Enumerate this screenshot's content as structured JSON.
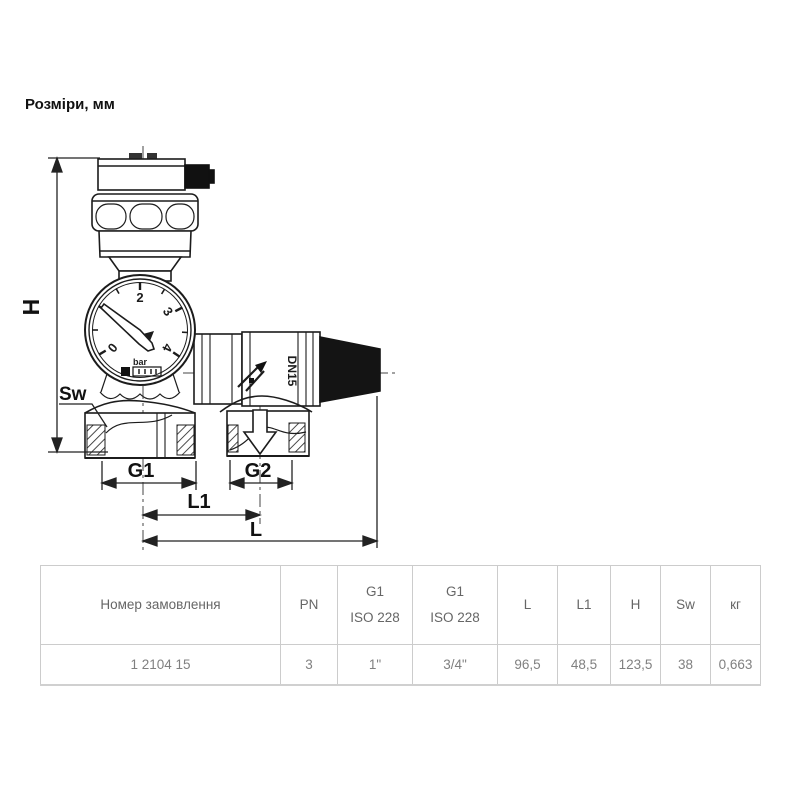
{
  "page": {
    "title": "Розміри, мм"
  },
  "drawing": {
    "dims": {
      "h": "H",
      "sw": "Sw",
      "g1": "G1",
      "g2": "G2",
      "l1": "L1",
      "l": "L"
    },
    "gauge": {
      "unit": "bar",
      "tick_0": "0",
      "tick_2": "2",
      "tick_3": "3",
      "tick_4": "4"
    },
    "valve": {
      "marking": "DN15"
    },
    "colors": {
      "line": "#1c1c1c",
      "cap_fill": "#141414",
      "centerline": "#444444"
    }
  },
  "table": {
    "columns": [
      {
        "line1": "Номер замовлення",
        "line2": ""
      },
      {
        "line1": "PN",
        "line2": ""
      },
      {
        "line1": "G1",
        "line2": "ISO 228"
      },
      {
        "line1": "G1",
        "line2": "ISO 228"
      },
      {
        "line1": "L",
        "line2": ""
      },
      {
        "line1": "L1",
        "line2": ""
      },
      {
        "line1": "H",
        "line2": ""
      },
      {
        "line1": "Sw",
        "line2": ""
      },
      {
        "line1": "кг",
        "line2": ""
      }
    ],
    "rows": [
      {
        "order_number": "1 2104 15",
        "values": [
          "3",
          "1\"",
          "3/4\"",
          "96,5",
          "48,5",
          "123,5",
          "38",
          "0,663"
        ]
      }
    ]
  }
}
